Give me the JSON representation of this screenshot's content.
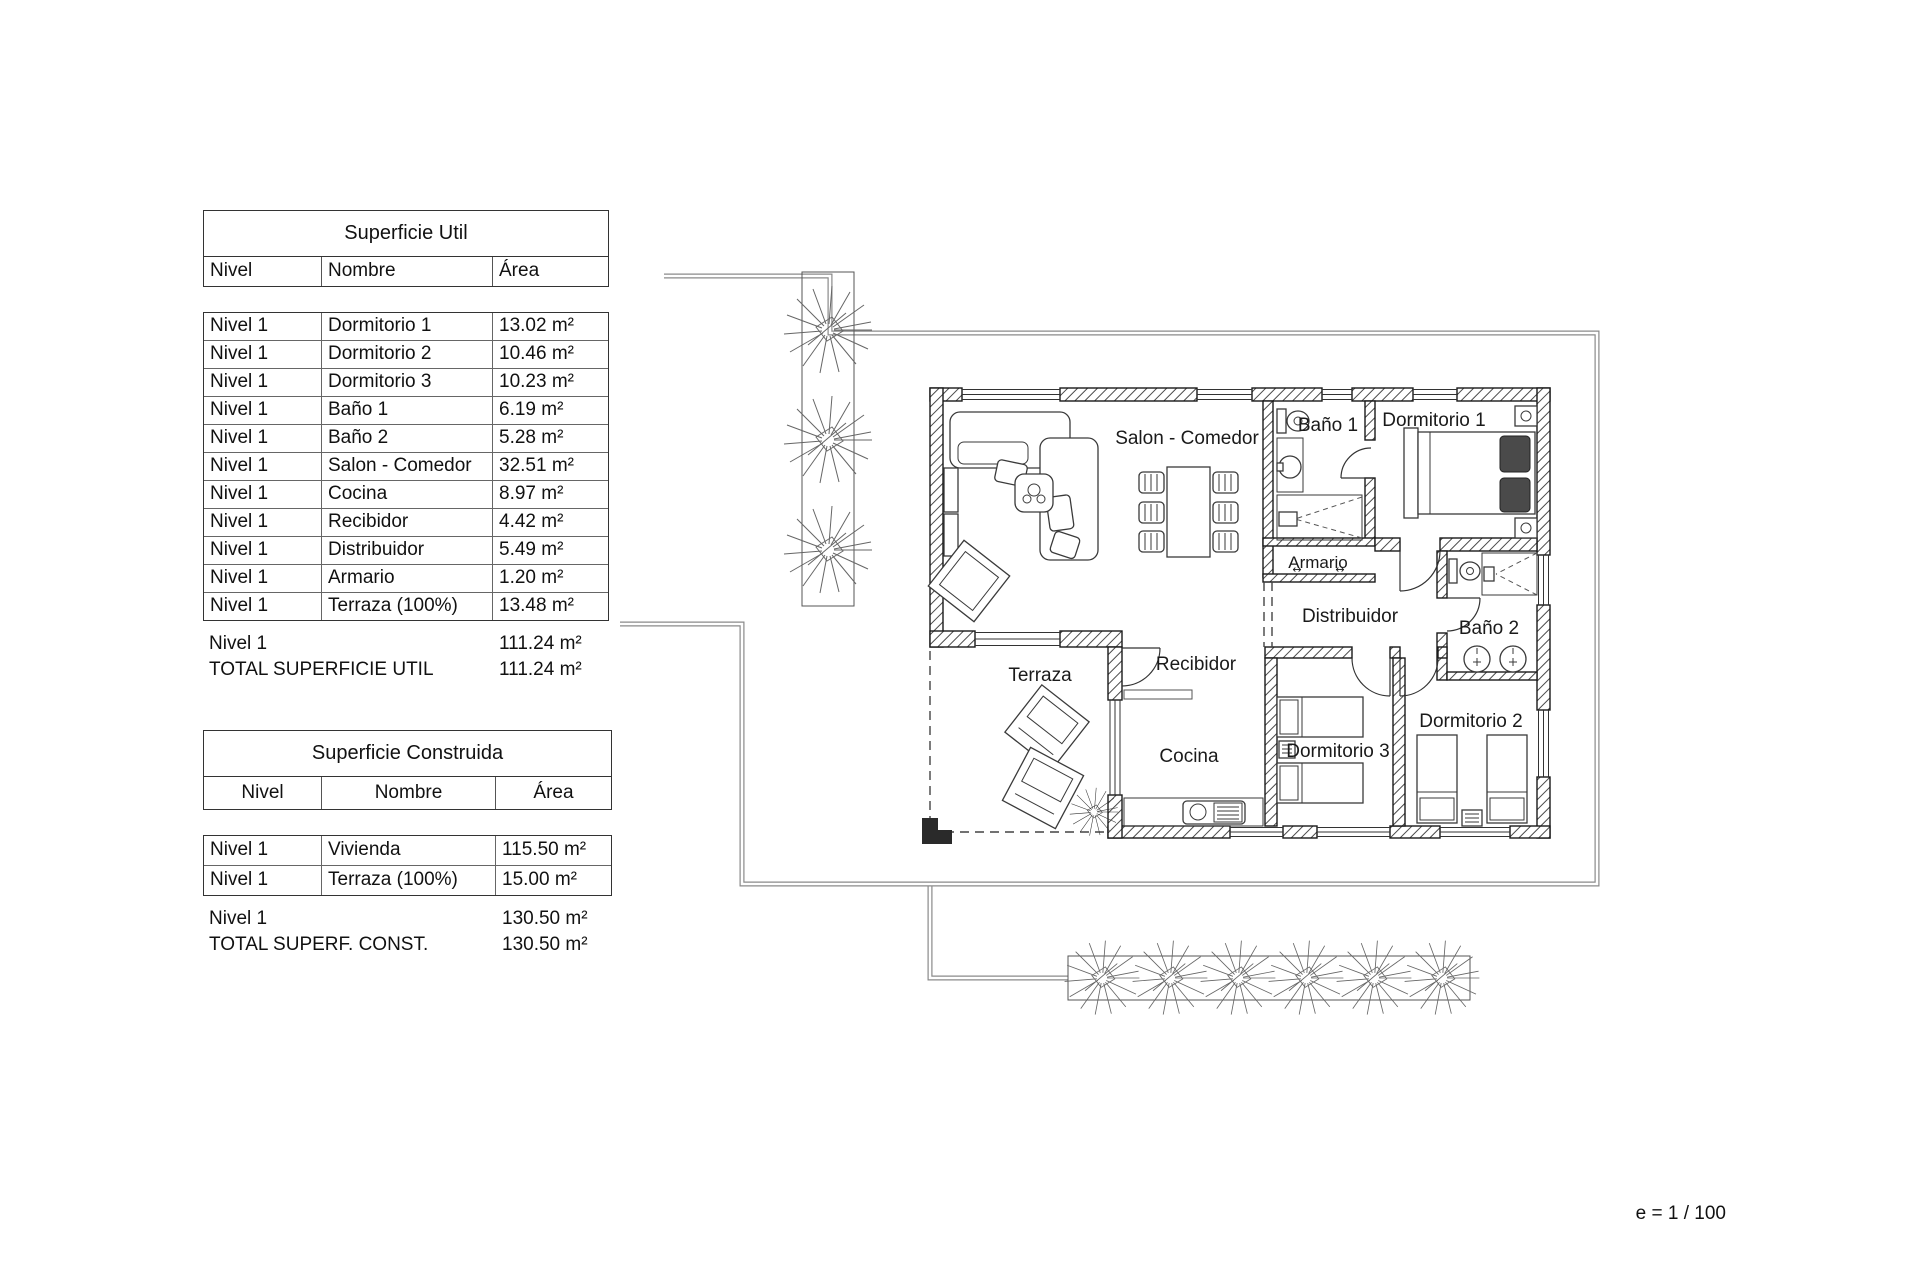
{
  "scale": {
    "label": "e = 1 / 100"
  },
  "tables": {
    "util": {
      "title": "Superficie Util",
      "columns": [
        "Nivel",
        "Nombre",
        "Área"
      ],
      "rows": [
        {
          "nivel": "Nivel 1",
          "nombre": "Dormitorio 1",
          "area": "13.02 m²"
        },
        {
          "nivel": "Nivel 1",
          "nombre": "Dormitorio 2",
          "area": "10.46 m²"
        },
        {
          "nivel": "Nivel 1",
          "nombre": "Dormitorio 3",
          "area": "10.23 m²"
        },
        {
          "nivel": "Nivel 1",
          "nombre": "Baño 1",
          "area": "6.19 m²"
        },
        {
          "nivel": "Nivel 1",
          "nombre": "Baño 2",
          "area": "5.28 m²"
        },
        {
          "nivel": "Nivel 1",
          "nombre": "Salon - Comedor",
          "area": "32.51 m²"
        },
        {
          "nivel": "Nivel 1",
          "nombre": "Cocina",
          "area": "8.97 m²"
        },
        {
          "nivel": "Nivel 1",
          "nombre": "Recibidor",
          "area": "4.42 m²"
        },
        {
          "nivel": "Nivel 1",
          "nombre": "Distribuidor",
          "area": "5.49 m²"
        },
        {
          "nivel": "Nivel 1",
          "nombre": "Armario",
          "area": "1.20 m²"
        },
        {
          "nivel": "Nivel 1",
          "nombre": "Terraza (100%)",
          "area": "13.48 m²"
        }
      ],
      "subtotal": {
        "nivel": "Nivel 1",
        "area": "111.24 m²"
      },
      "total": {
        "label": "TOTAL SUPERFICIE UTIL",
        "area": "111.24 m²"
      }
    },
    "construida": {
      "title": "Superficie Construida",
      "columns": [
        "Nivel",
        "Nombre",
        "Área"
      ],
      "rows": [
        {
          "nivel": "Nivel 1",
          "nombre": "Vivienda",
          "area": "115.50 m²"
        },
        {
          "nivel": "Nivel 1",
          "nombre": "Terraza (100%)",
          "area": "15.00 m²"
        }
      ],
      "subtotal": {
        "nivel": "Nivel 1",
        "area": "130.50 m²"
      },
      "total": {
        "label": "TOTAL SUPERF. CONST.",
        "area": "130.50 m²"
      }
    }
  },
  "floorplan": {
    "rooms": {
      "salon": "Salon - Comedor",
      "bano1": "Baño 1",
      "dormitorio1": "Dormitorio 1",
      "armario": "Armario",
      "distribuidor": "Distribuidor",
      "bano2": "Baño 2",
      "dormitorio2": "Dormitorio 2",
      "dormitorio3": "Dormitorio 3",
      "cocina": "Cocina",
      "recibidor": "Recibidor",
      "terraza": "Terraza"
    },
    "armario_arrows": "↔"
  }
}
